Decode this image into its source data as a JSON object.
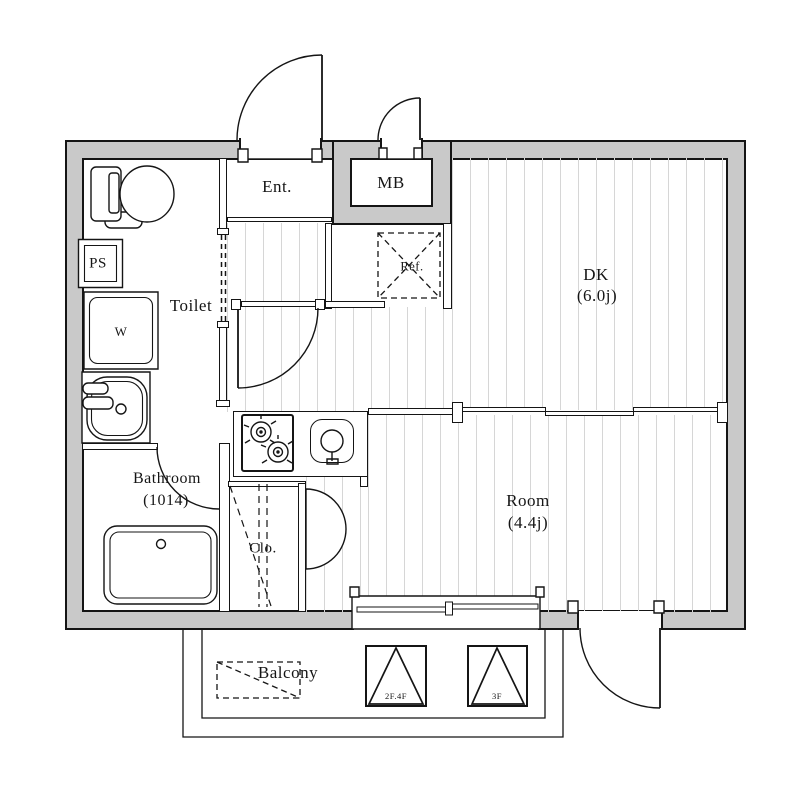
{
  "plan": {
    "entrance": "Ent.",
    "meter_box": "MB",
    "pipe_space": "PS",
    "washer": "W",
    "toilet": "Toilet",
    "fridge": "Ref.",
    "dk": "DK",
    "dk_size": "(6.0j)",
    "room": "Room",
    "room_size": "(4.4j)",
    "bathroom": "Bathroom",
    "bathroom_size": "(1014)",
    "closet": "Clo.",
    "balcony": "Balcony",
    "hatch_upper_floors": "2F.4F",
    "hatch_third_floor": "3F"
  },
  "colors": {
    "wall_fill": "#c9c9c9",
    "line": "#151515",
    "floor_board_line": "#d6d6d6"
  }
}
